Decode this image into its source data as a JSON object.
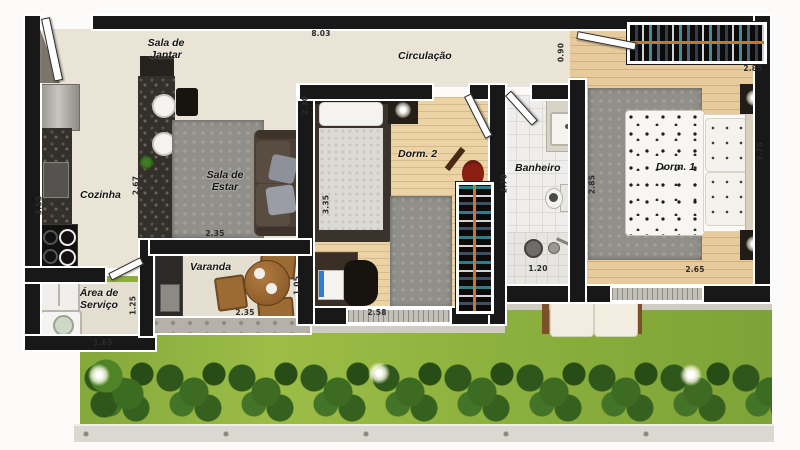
{
  "plan": {
    "title": "apartment floor plan",
    "rooms": {
      "sala_jantar": "Sala de Jantar",
      "circulacao": "Circulação",
      "cozinha": "Cozinha",
      "sala_estar": "Sala de Estar",
      "dorm2": "Dorm. 2",
      "banheiro": "Banheiro",
      "dorm1": "Dorm. 1",
      "varanda": "Varanda",
      "area_servico": "Área de Serviço"
    },
    "dims": {
      "top_width": "8.03",
      "corridor": "0.90",
      "sala_h": "2.30",
      "cozinha_w": "2.67",
      "cozinha_h": "3.55",
      "sala_w": "2.35",
      "dorm2_h": "3.35",
      "dorm2_w": "2.58",
      "varanda_h": "1.05",
      "varanda_w": "2.35",
      "servico_h": "1.25",
      "servico_w": "1.65",
      "banheiro_h": "2.70",
      "banheiro_w": "1.20",
      "dorm1_wall": "2.85",
      "closet_w": "2.85",
      "dorm1_h": "3.75",
      "dorm1_w": "2.65"
    },
    "colors": {
      "wall": "#181818",
      "floor_beige": "#e9e4d6",
      "wood": "#e7cb9d",
      "granite": "#33302b",
      "grass": "#8db13e",
      "hedge": "#2f571c",
      "closet_rod_orange": "#c07a30"
    }
  }
}
